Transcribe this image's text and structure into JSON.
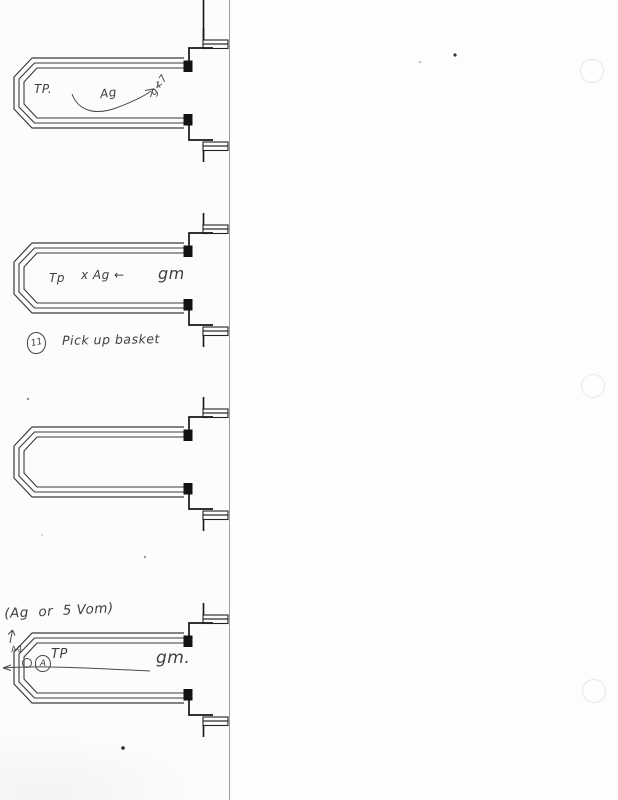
{
  "colors": {
    "paper": "#fcfcfb",
    "ink": "#3a3a3a",
    "fitting_ink": "#1a1a1a",
    "pencil": "#4a4a4a",
    "fold_line": "#9c9c9c"
  },
  "diagram1": {
    "label_tp": "TP.",
    "label_ag": "Ag",
    "scribble": "g≮7"
  },
  "diagram2": {
    "label_tp": "Tp",
    "label_ag": "x Ag ←",
    "label_gm": "gm"
  },
  "note": {
    "number": "11",
    "text": "Pick up basket"
  },
  "diagram4": {
    "header": "(Ag  or  5 Vom)",
    "tip_scribble": "Ag",
    "circled_letter": "A",
    "label_tp": "TP",
    "label_gm": "gm."
  }
}
